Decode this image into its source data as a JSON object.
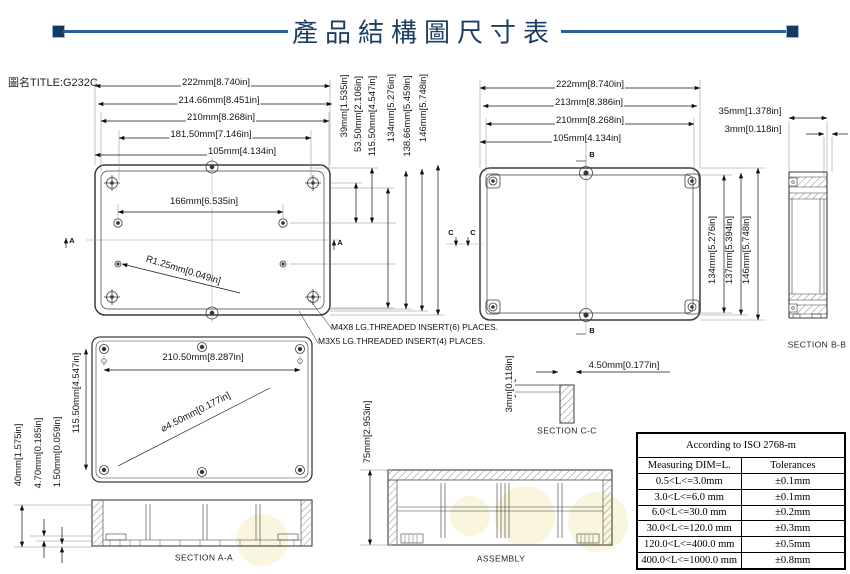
{
  "header": {
    "title": "產品結構圖尺寸表",
    "doc_title": "圖名TITLE:G232C"
  },
  "colors": {
    "accent_navy": "#123a63",
    "title_line_blue": "#2d6096",
    "drawing_line": "#3c3c3c"
  },
  "view_bottom": {
    "h_dims": [
      "222mm[8.740in]",
      "214.66mm[8.451in]",
      "210mm[8.268in]",
      "181.50mm[7.146in]",
      "105mm[4.134in]"
    ],
    "v_dims": [
      "39mm[1.535in]",
      "53.50mm[2.106in]",
      "115.50mm[4.547in]",
      "134mm[5.276in]",
      "138.66mm[5.459in]",
      "146mm[5.748in]"
    ],
    "hole_dim": "166mm[6.535in]",
    "radius_dim": "R1.25mm[0.049in]",
    "marker_a": "A"
  },
  "view_top": {
    "h_dims": [
      "222mm[8.740in]",
      "213mm[8.386in]",
      "210mm[8.268in]",
      "105mm[4.134in]"
    ],
    "v_dims": [
      "134mm[5.276in]",
      "137mm[5.394in]",
      "146mm[5.748in]"
    ],
    "side_dims": [
      "35mm[1.378in]",
      "3mm[0.118in]"
    ],
    "marker_b": "B",
    "marker_c": "C"
  },
  "section_bb": {
    "label": "SECTION B-B"
  },
  "view_cover": {
    "width_dim": "210.50mm[8.287in]",
    "height_dim": "115.50mm[4.547in]",
    "hole_dim": "⌀4.50mm[0.177in]",
    "left_dims": [
      "40mm[1.575in]",
      "4.70mm[0.185in]",
      "1.50mm[0.059in]"
    ],
    "section_label": "SECTION A-A"
  },
  "section_cc": {
    "thickness_dim": "3mm[0.118in]",
    "width_dim": "4.50mm[0.177in]",
    "label": "SECTION C-C"
  },
  "assembly": {
    "height_dim": "75mm[2.953in]",
    "label": "ASSEMBLY"
  },
  "notes": [
    "M4X8 LG.THREADED INSERT(6) PLACES.",
    "M3X5 LG.THREADED INSERT(4) PLACES."
  ],
  "tolerance_table": {
    "title": "According to ISO 2768-m",
    "columns": [
      "Measuring  DIM=L.",
      "Tolerances"
    ],
    "rows": [
      {
        "range": "0.5<L<=3.0mm",
        "tol": "±0.1mm"
      },
      {
        "range": "3.0<L<=6.0 mm",
        "tol": "±0.1mm"
      },
      {
        "range": "6.0<L<=30.0 mm",
        "tol": "±0.2mm"
      },
      {
        "range": "30.0<L<=120.0 mm",
        "tol": "±0.3mm"
      },
      {
        "range": "120.0<L<=400.0 mm",
        "tol": "±0.5mm"
      },
      {
        "range": "400.0<L<=1000.0 mm",
        "tol": "±0.8mm"
      }
    ]
  }
}
